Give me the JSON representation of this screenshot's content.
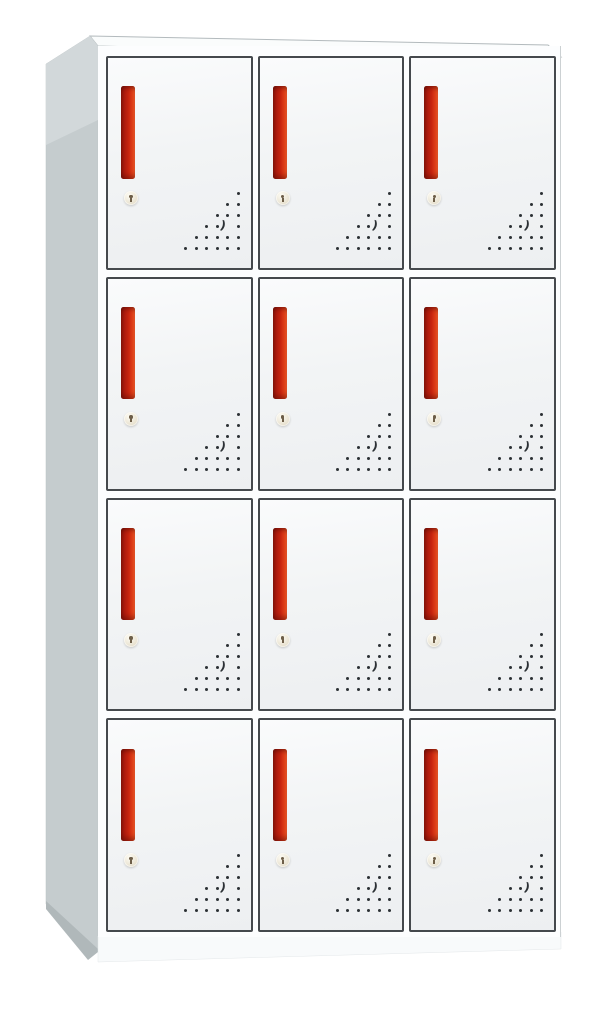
{
  "scene": {
    "description": "Product photo of a 12-compartment steel locker cabinet with red vertical handles, round keyhole locks and triangular corner vent holes",
    "background_color": "#ffffff"
  },
  "cabinet": {
    "rows": 4,
    "columns": 3,
    "door_count": 12,
    "parts": {
      "handle": "red-vertical-handle",
      "lock": "round-keyhole-lock",
      "vents": "corner-triangle-vent-holes"
    },
    "vents": {
      "rows": 6,
      "spacing_x": 10.5,
      "spacing_y": 11,
      "dot_size": 3,
      "crescent_row": 3,
      "crescent_col_from_right": 1,
      "crescent_glyph": ")"
    },
    "theme": {
      "background": "#ffffff",
      "side-light": "#d2d8da",
      "side-mid": "#c5ccce",
      "side-dark": "#b0b8ba",
      "top-face": "#fafcfc",
      "front-face": "#fcfdfe",
      "edge-line": "#b3babd",
      "door-fill-top": "#fafbfc",
      "door-fill-mid": "#f2f4f5",
      "door-fill-bottom": "#edeff1",
      "door-border": "#45494d",
      "handle-dark": "#86150b",
      "handle-red": "#c8250f",
      "handle-orange": "#f05c2c",
      "lock-light": "#fdfbf3",
      "lock-mid": "#eae4d3",
      "lock-dark": "#d3cbb3",
      "keyhole": "#6d5e48",
      "vent-dot": "#2c3135",
      "base-face": "#f8fafb"
    }
  }
}
